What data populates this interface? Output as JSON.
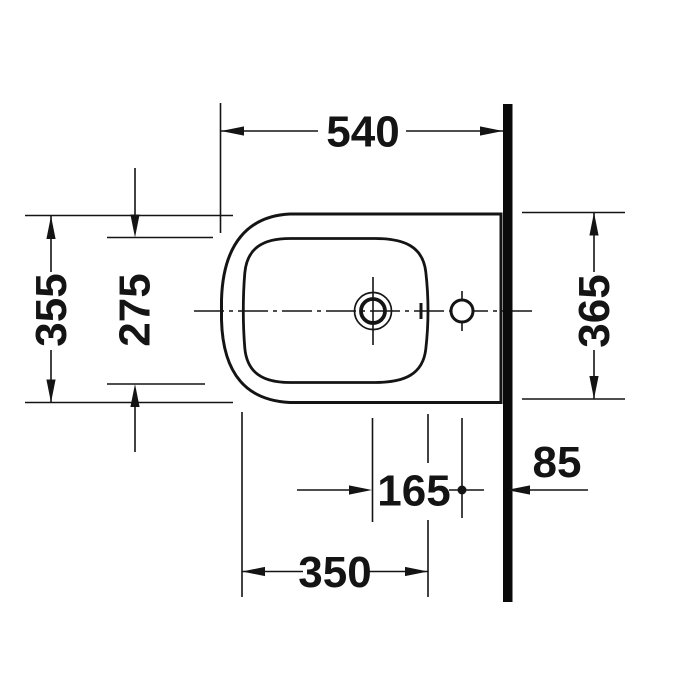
{
  "page": {
    "background_color": "#ffffff"
  },
  "drawing": {
    "type": "technical-plan-view",
    "subject": "wall-mounted bidet, top view with installation dimensions",
    "line_color": "#141414",
    "wall_color": "#0a0a0a",
    "labels": {
      "overall_depth": "540",
      "outer_width_front": "355",
      "bowl_inner_width": "275",
      "outer_width_at_wall": "365",
      "tap_hole_offset": "165",
      "bowl_inner_depth": "350",
      "rear_hole_wall_distance": "85"
    }
  }
}
